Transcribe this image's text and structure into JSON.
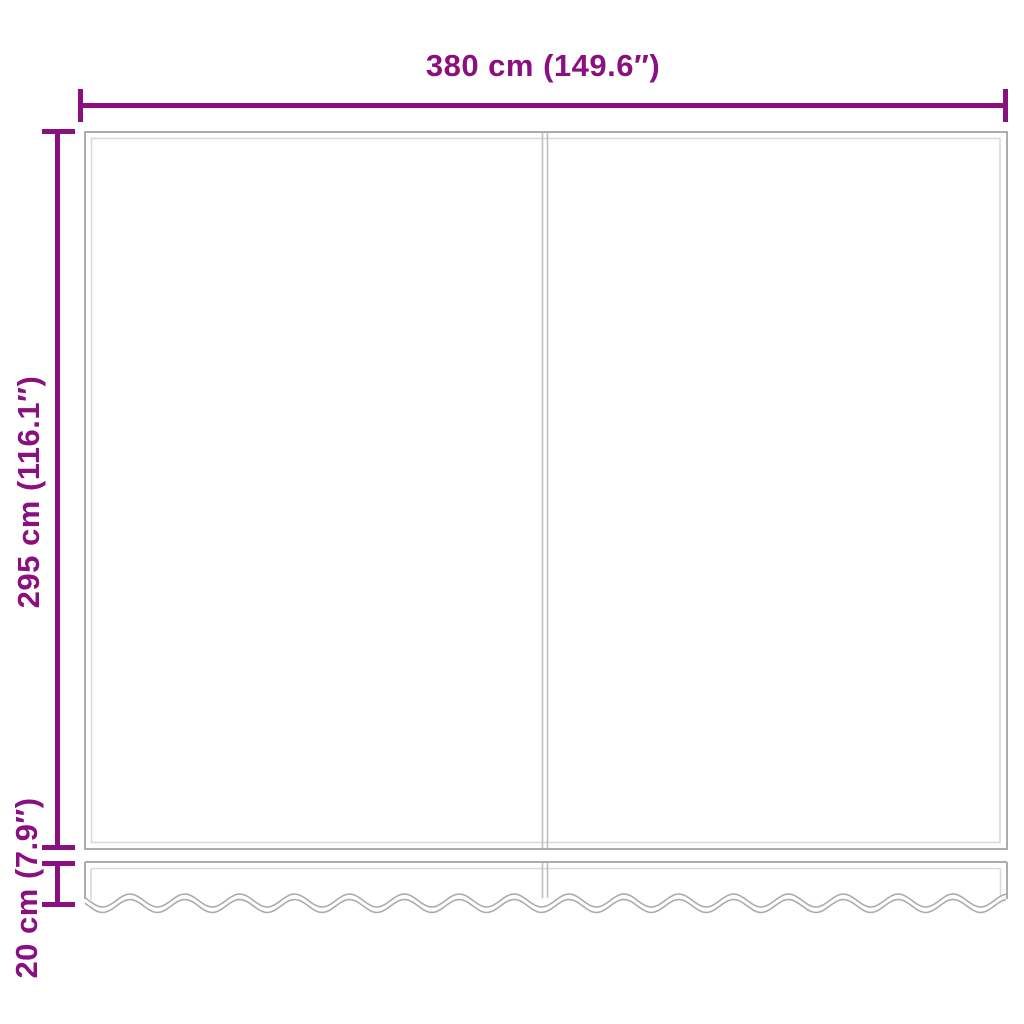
{
  "diagram": {
    "labels": {
      "width": "380 cm (149.6″)",
      "height": "295 cm (116.1″)",
      "valance": "20 cm (7.9″)"
    },
    "colors": {
      "dimension": "#8a1080",
      "outline": "#acacac",
      "outline_light": "#d9d9d9",
      "outline_mid": "#c2bebe",
      "background": "#ffffff"
    }
  }
}
